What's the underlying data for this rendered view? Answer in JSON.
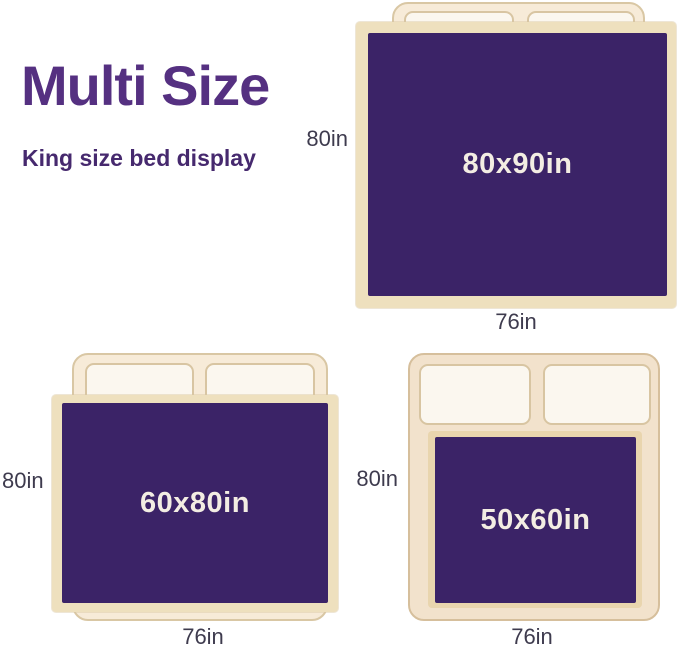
{
  "header": {
    "title": "Multi Size",
    "subtitle": "King size bed display"
  },
  "colors": {
    "title_purple": "#553081",
    "subtitle_purple": "#46296e",
    "blanket_purple": "#3b2367",
    "blanket_text": "#f3ede3",
    "bed_cream": "#f7ebd8",
    "bed_tan": "#f2e2cc",
    "bed_border": "#d9c7a4",
    "pillow_fill": "#fbf7ef",
    "blanket_trim": "#eee0be",
    "dimension_text": "#3e3b4e"
  },
  "beds": [
    {
      "blanket_label": "80x90in",
      "side_label": "80in",
      "bottom_label": "76in"
    },
    {
      "blanket_label": "60x80in",
      "side_label": "80in",
      "bottom_label": "76in"
    },
    {
      "blanket_label": "50x60in",
      "side_label": "80in",
      "bottom_label": "76in"
    }
  ]
}
